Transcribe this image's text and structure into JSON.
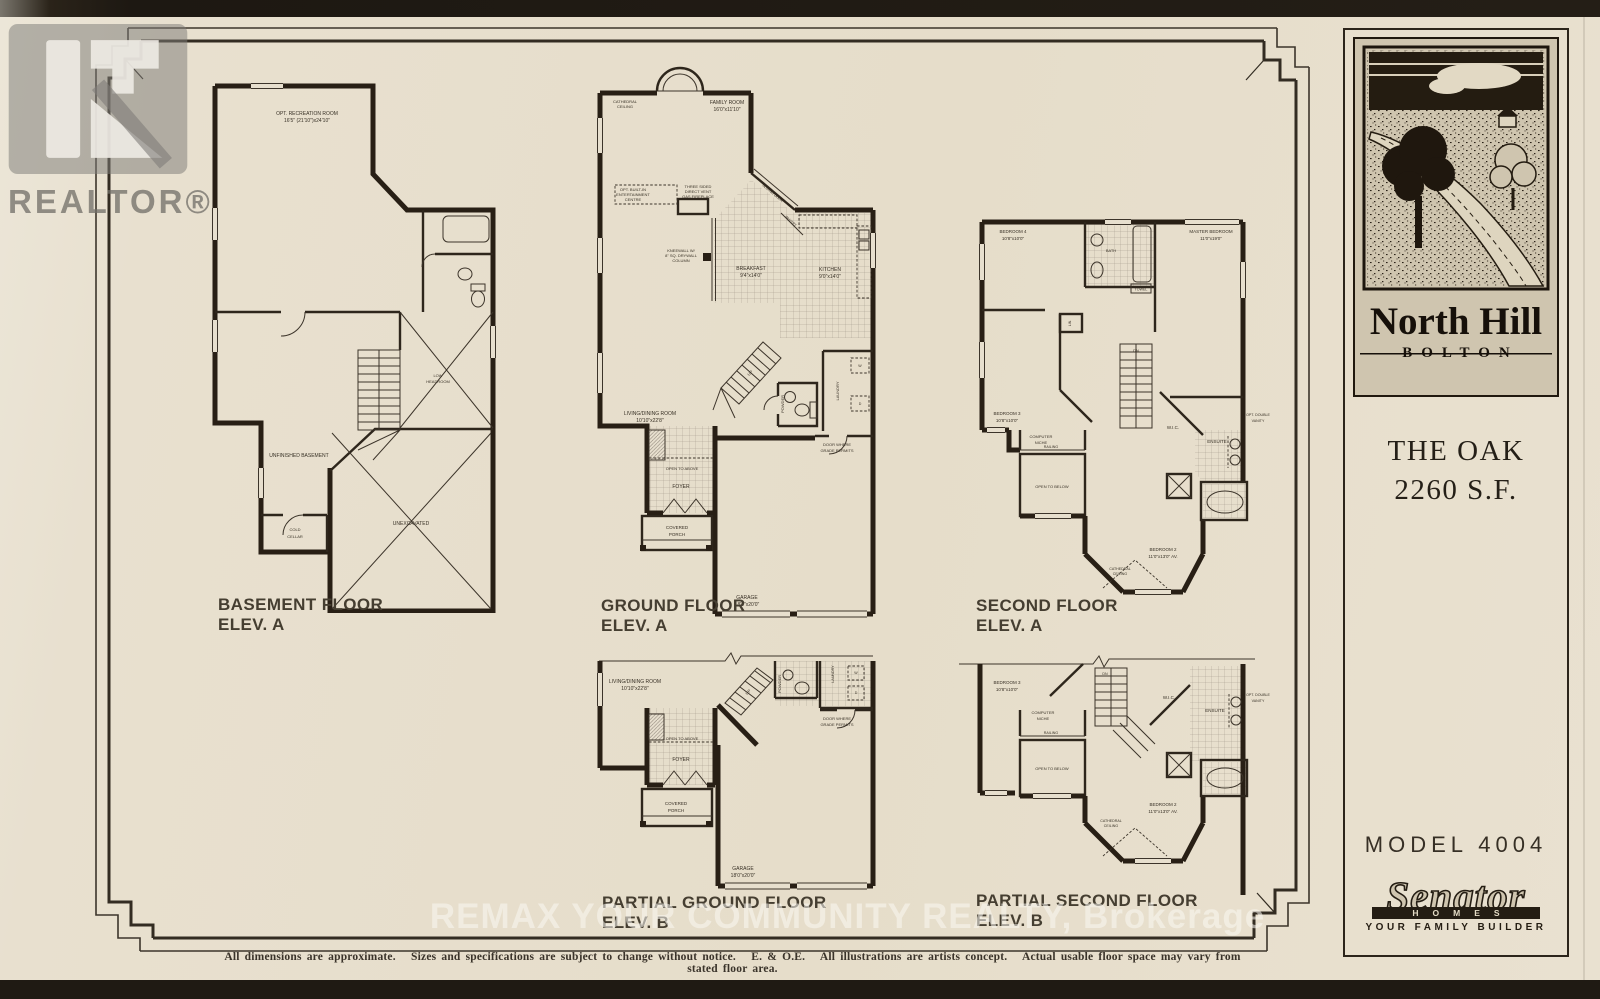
{
  "branding": {
    "realtor_watermark": "REALTOR®",
    "remax_watermark": "REMAX YOUR COMMUNITY REALTY, Brokerage",
    "community": {
      "name": "North Hill",
      "location": "BOLTON"
    },
    "model": {
      "name": "THE OAK",
      "area": "2260 S.F.",
      "number": "MODEL 4004"
    },
    "builder": {
      "name": "Senator",
      "word": "HOMES",
      "tagline": "YOUR FAMILY BUILDER"
    }
  },
  "disclaimer": "All dimensions are approximate.   Sizes and specifications are subject to change without notice.   E. & O.E.   All illustrations are artists concept.   Actual usable floor space may vary from stated floor area.",
  "captions": {
    "basement": [
      "BASEMENT FLOOR",
      "ELEV. A"
    ],
    "ground": [
      "GROUND FLOOR",
      "ELEV. A"
    ],
    "second": [
      "SECOND FLOOR",
      "ELEV. A"
    ],
    "partial_ground": [
      "PARTIAL GROUND FLOOR",
      "ELEV. B"
    ],
    "partial_second": [
      "PARTIAL SECOND FLOOR",
      "ELEV. B"
    ]
  },
  "rooms": {
    "rec_room": [
      "OPT. RECREATION ROOM",
      "16'5\" (21'10\")x24'10\""
    ],
    "low_headroom": [
      "LOW",
      "HEADROOM"
    ],
    "unfinished": "UNFINISHED BASEMENT",
    "cold_cellar": [
      "COLD",
      "CELLAR"
    ],
    "unexcavated": "UNEXCAVATED",
    "cathedral": [
      "CATHEDRAL",
      "CEILING"
    ],
    "family": [
      "FAMILY ROOM",
      "16'0\"x11'10\""
    ],
    "entertainment": [
      "OPT. BUILT-IN",
      "ENTERTAINMENT",
      "CENTRE"
    ],
    "fireplace": [
      "THREE SIDED",
      "DIRECT VENT",
      "GAS FIREPLACE"
    ],
    "kneewall": [
      "KNEEWALL W/",
      "8\" SQ. DRYWALL",
      "COLUMN"
    ],
    "sliding_door": "SLIDING DOOR",
    "pantry": "PANTRY",
    "breakfast": [
      "BREAKFAST",
      "9'4\"x14'0\""
    ],
    "kitchen": [
      "KITCHEN",
      "9'0\"x14'0\""
    ],
    "living": [
      "LIVING/DINING ROOM",
      "10'10\"x22'8\""
    ],
    "powder": "POWDER",
    "laundry": "LAUNDRY",
    "washer": "W",
    "dryer": "D",
    "door_grade": [
      "DOOR WHERE",
      "GRADE PERMITS"
    ],
    "open_above": "OPEN TO ABOVE",
    "foyer": "FOYER",
    "porch": [
      "COVERED",
      "PORCH"
    ],
    "garage": [
      "GARAGE",
      "18'0\"x20'0\""
    ],
    "up": "UP",
    "dn": "DN",
    "bedroom4": [
      "BEDROOM 4",
      "10'8\"x10'0\""
    ],
    "bath": "BATH",
    "towel": "TOWEL",
    "master": [
      "MASTER BEDROOM",
      "11'0\"x19'0\""
    ],
    "bedroom3": [
      "BEDROOM 3",
      "10'8\"x10'0\""
    ],
    "linen": "LIN.",
    "computer_niche": [
      "COMPUTER",
      "NICHE"
    ],
    "railing": "RAILING",
    "open_below": "OPEN TO BELOW",
    "wic": "W.I.C.",
    "ensuite": "ENSUITE",
    "opt_vanity": [
      "OPT. DOUBLE",
      "VANITY"
    ],
    "bedroom2": [
      "BEDROOM 2",
      "11'0\"x13'0\" AV."
    ]
  }
}
